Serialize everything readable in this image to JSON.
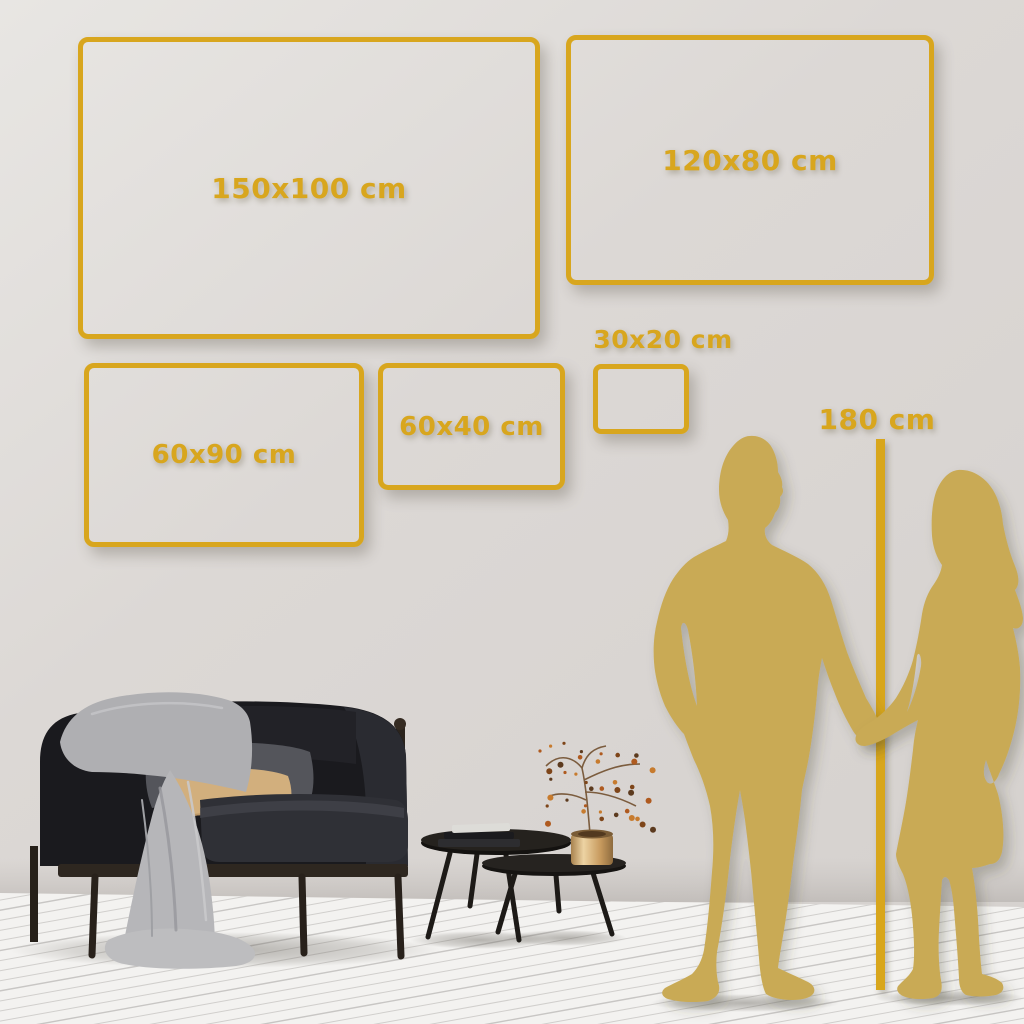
{
  "page": {
    "kind": "wall-art-size-guide"
  },
  "sizes": [
    {
      "id": "150x100",
      "label": "150x100 cm",
      "width_cm": 150,
      "height_cm": 100
    },
    {
      "id": "120x80",
      "label": "120x80 cm",
      "width_cm": 120,
      "height_cm": 80
    },
    {
      "id": "60x90",
      "label": "60x90 cm",
      "width_cm": 90,
      "height_cm": 60
    },
    {
      "id": "60x40",
      "label": "60x40 cm",
      "width_cm": 60,
      "height_cm": 40
    },
    {
      "id": "30x20",
      "label": "30x20 cm",
      "width_cm": 30,
      "height_cm": 20
    }
  ],
  "reference": {
    "label": "180 cm",
    "value_cm": 180
  },
  "colors": {
    "frame_gold": "#D8A61E",
    "silhouette_gold": "#C9AA55",
    "wall": "#DCD8D5",
    "floor": "#F3F2F0",
    "sofa": "#1A1A1E",
    "pillow_tan": "#D2AF7D",
    "pillow_gray": "#54555B",
    "blanket": "#B4B4B7",
    "wood_dark": "#2A241E",
    "vase_brass": "#D9B57C",
    "berries": "#B05A20"
  },
  "scene_objects": [
    "sofa",
    "throw-blanket",
    "pillows",
    "nesting-coffee-tables",
    "book-stack",
    "brass-vase",
    "dried-branch",
    "man-silhouette",
    "woman-silhouette",
    "height-line",
    "wood-floor",
    "wall"
  ]
}
